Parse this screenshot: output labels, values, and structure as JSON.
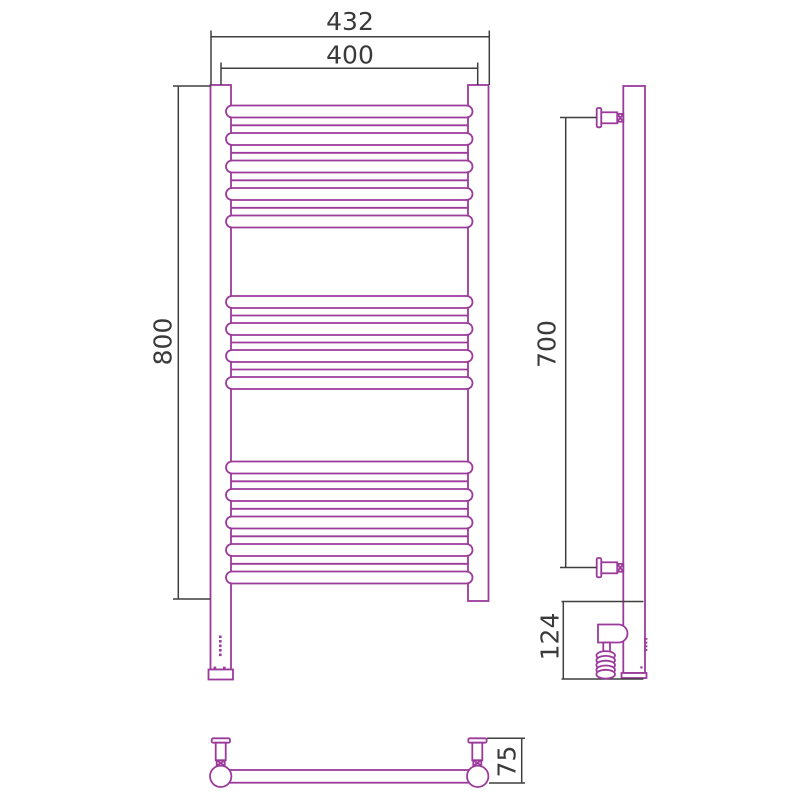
{
  "drawing": {
    "type": "heated-towel-rail-technical-drawing",
    "views": {
      "front": {
        "overall_width_mm": "432",
        "rail_centers_width_mm": "400",
        "overall_height_mm": "800"
      },
      "side": {
        "bracket_distance_mm": "700",
        "heating_element_length_mm": "124"
      },
      "bottom": {
        "wall_offset_mm": "75"
      }
    }
  },
  "colors": {
    "product_outline": "#9b3a9b",
    "dimension_lines": "#3f3f3f",
    "dimension_text": "#3a3a3a",
    "background": "#ffffff"
  }
}
